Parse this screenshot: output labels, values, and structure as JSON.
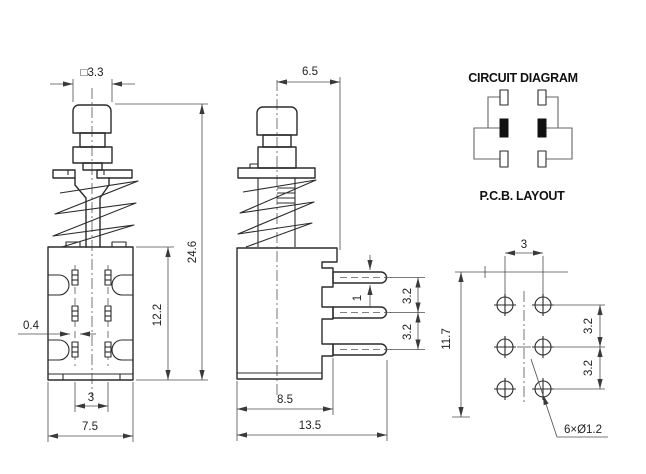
{
  "drawing_title": "Push button switch engineering drawing",
  "line_color": "#2b2b2b",
  "background": "#ffffff",
  "front_view": {
    "dims": {
      "button_width": "□3.3",
      "total_height": "24.6",
      "body_height": "12.2",
      "pin_width": "0.4",
      "pin_spacing": "3",
      "body_width": "7.5"
    }
  },
  "side_view": {
    "dims": {
      "stem_to_edge": "6.5",
      "pin_thickness": "1",
      "pin_pitch_upper": "3.2",
      "pin_pitch_lower": "3.2",
      "body_depth": "8.5",
      "total_depth": "13.5"
    }
  },
  "circuit_diagram": {
    "title": "CIRCUIT DIAGRAM"
  },
  "pcb_layout": {
    "title": "P.C.B. LAYOUT",
    "dims": {
      "col_spacing": "3",
      "height": "11.7",
      "row_pitch_upper": "3.2",
      "row_pitch_lower": "3.2",
      "hole_note": "6×Ø1.2"
    }
  }
}
